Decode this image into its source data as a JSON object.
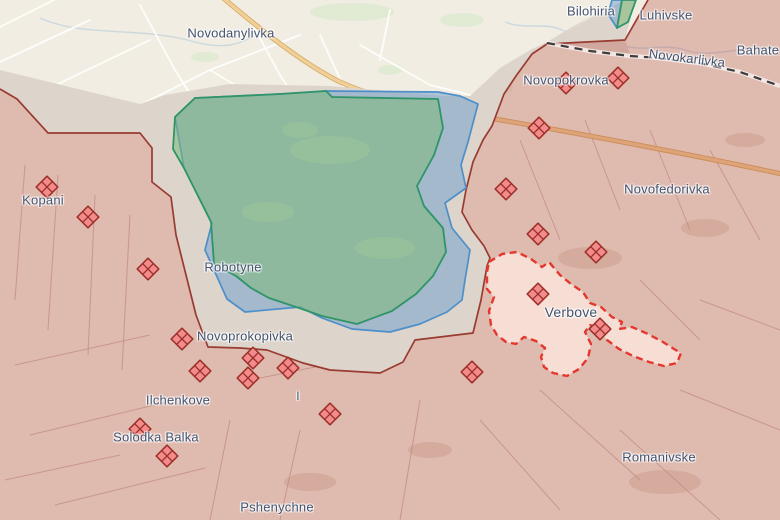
{
  "map": {
    "colors": {
      "base_fill": "#f1ede3",
      "grey_zone_fill": "#ddd5cb",
      "occupied_fill": "rgba(174,48,38,0.27)",
      "occupied_border": "#993b31",
      "liberated_fill": "rgba(124,186,120,0.55)",
      "liberated_border": "#2f9469",
      "advance_fill": "rgba(108,158,206,0.50)",
      "advance_border": "#4d8fc9",
      "contested_fill": "#f6ded4",
      "contested_border": "#e4372e",
      "road_major": "#f0d098",
      "admin_border": "#3d3d3d",
      "label_color": "#44536e",
      "marker_fill": "#f28b8b",
      "marker_border": "#9c2f28"
    },
    "labels": [
      {
        "text": "Novodanylivka",
        "x": 231,
        "y": 33,
        "size": 13
      },
      {
        "text": "Bilohiria",
        "x": 591,
        "y": 11,
        "size": 13
      },
      {
        "text": "Luhivske",
        "x": 666,
        "y": 15,
        "size": 13
      },
      {
        "text": "Novokarlivka",
        "x": 687,
        "y": 58,
        "size": 13,
        "rot": 7
      },
      {
        "text": "Bahate",
        "x": 758,
        "y": 50,
        "size": 13
      },
      {
        "text": "Novopokrovka",
        "x": 566,
        "y": 80,
        "size": 13
      },
      {
        "text": "Novofedorivka",
        "x": 667,
        "y": 189,
        "size": 13
      },
      {
        "text": "Kopani",
        "x": 43,
        "y": 200,
        "size": 13
      },
      {
        "text": "Robotyne",
        "x": 233,
        "y": 267,
        "size": 13
      },
      {
        "text": "Novoprokopivka",
        "x": 245,
        "y": 336,
        "size": 13
      },
      {
        "text": "Verbove",
        "x": 571,
        "y": 312,
        "size": 14
      },
      {
        "text": "Ilchenkove",
        "x": 178,
        "y": 400,
        "size": 13
      },
      {
        "text": "Solodka Balka",
        "x": 156,
        "y": 437,
        "size": 13
      },
      {
        "text": "Pshenychne",
        "x": 277,
        "y": 507,
        "size": 13
      },
      {
        "text": "Romanivske",
        "x": 659,
        "y": 457,
        "size": 13
      },
      {
        "text": "I",
        "x": 298,
        "y": 396,
        "size": 12
      }
    ],
    "markers": [
      {
        "x": 47,
        "y": 187
      },
      {
        "x": 88,
        "y": 217
      },
      {
        "x": 148,
        "y": 269
      },
      {
        "x": 182,
        "y": 339
      },
      {
        "x": 200,
        "y": 371
      },
      {
        "x": 140,
        "y": 429
      },
      {
        "x": 167,
        "y": 456
      },
      {
        "x": 253,
        "y": 358
      },
      {
        "x": 248,
        "y": 378
      },
      {
        "x": 288,
        "y": 368
      },
      {
        "x": 330,
        "y": 414
      },
      {
        "x": 566,
        "y": 83
      },
      {
        "x": 618,
        "y": 78
      },
      {
        "x": 539,
        "y": 128
      },
      {
        "x": 506,
        "y": 189
      },
      {
        "x": 538,
        "y": 234
      },
      {
        "x": 596,
        "y": 252
      },
      {
        "x": 538,
        "y": 294
      },
      {
        "x": 600,
        "y": 329
      },
      {
        "x": 472,
        "y": 372
      }
    ]
  }
}
